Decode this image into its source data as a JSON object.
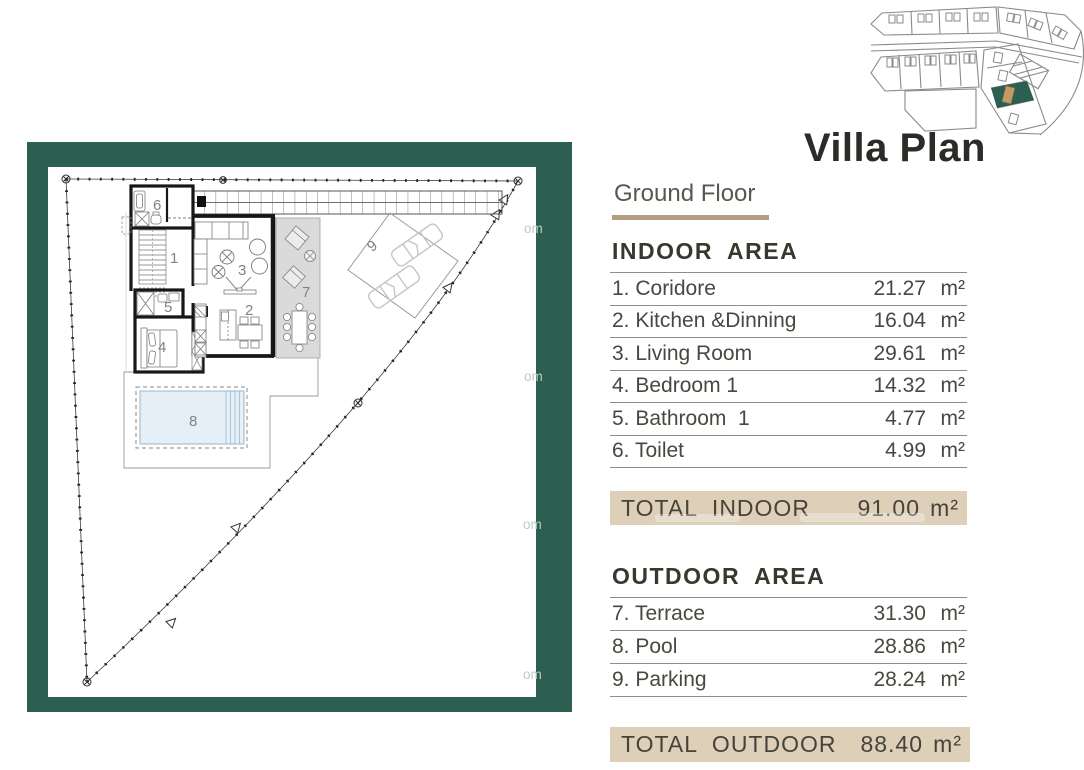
{
  "header": {
    "title": "Villa Plan",
    "subtitle": "Ground Floor"
  },
  "indoor": {
    "heading": "INDOOR AREA",
    "rows": [
      {
        "label": "1. Coridore",
        "value": "21.27",
        "unit": "m²"
      },
      {
        "label": "2. Kitchen &Dinning",
        "value": "16.04",
        "unit": "m²"
      },
      {
        "label": "3. Living Room",
        "value": "29.61",
        "unit": "m²"
      },
      {
        "label": "4. Bedroom 1",
        "value": "14.32",
        "unit": "m²"
      },
      {
        "label": "5. Bathroom  1",
        "value": "4.77",
        "unit": "m²"
      },
      {
        "label": "6. Toilet",
        "value": "4.99",
        "unit": "m²"
      }
    ],
    "total": {
      "label": "TOTAL  INDOOR",
      "value": "91.00",
      "unit": "m²"
    }
  },
  "outdoor": {
    "heading": "OUTDOOR AREA",
    "rows": [
      {
        "label": "7. Terrace",
        "value": "31.30",
        "unit": "m²"
      },
      {
        "label": "8. Pool",
        "value": "28.86",
        "unit": "m²"
      },
      {
        "label": "9. Parking",
        "value": "28.24",
        "unit": "m²"
      }
    ],
    "total": {
      "label": "TOTAL  OUTDOOR",
      "value": "88.40",
      "unit": "m²"
    }
  },
  "floor_plan": {
    "room_labels": [
      "1",
      "2",
      "3",
      "4",
      "5",
      "6",
      "7",
      "8",
      "9"
    ],
    "watermark_fragment": "om"
  },
  "colors": {
    "frame_green": "#2c5e51",
    "accent_tan": "#ddcfb8",
    "underline_tan": "#b19e80",
    "pool_blue": "#e4eff8",
    "terrace_gray": "#dadada",
    "highlight_plot_green": "#2c5e51",
    "highlight_building_tan": "#c29a63"
  }
}
